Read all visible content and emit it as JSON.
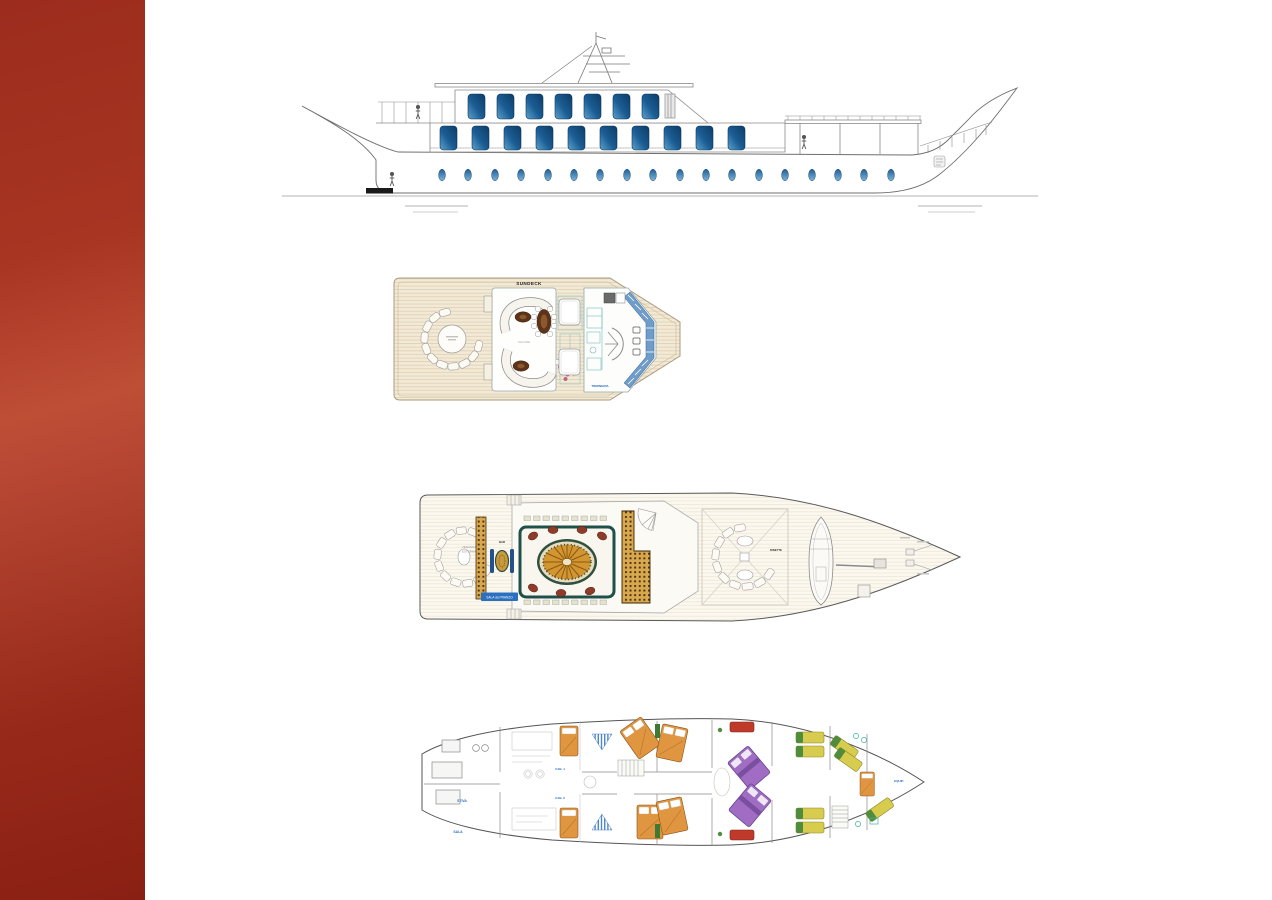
{
  "page": {
    "background": "#ffffff"
  },
  "sidebar": {
    "width_px": 145,
    "color_top": "#9c2c1d",
    "color_mid": "#bf4e37",
    "color_bottom": "#8a2013"
  },
  "profile_view": {
    "description": "Motor yacht side profile elevation drawing",
    "upper_deck_window_count": 7,
    "main_deck_window_count": 10,
    "hull_porthole_count": 18,
    "window_color": "#1b5d94",
    "porthole_color": "#2f74ad",
    "hull_color": "#ffffff",
    "line_color": "#6f6f6f"
  },
  "sun_deck": {
    "title": "SUNDECK",
    "label_salone": "SALONE",
    "label_timoneria": "TIMONERIA",
    "deck_color": "#f2e9d6",
    "windshield_color": "#6f9cc9",
    "table_color": "#5f3318",
    "pink_chair_color": "#c9628a"
  },
  "main_deck": {
    "label_veranda_line1": "VERANDA",
    "label_veranda_line2": "ESTERNA",
    "label_sala_pranzo": "SALA da PRANZO",
    "label_bar": "BAR",
    "label_dinette": "DINETTE",
    "carpet_border_color": "#20504a",
    "sunburst_color": "#d2952f",
    "armchair_color": "#8e3b2a",
    "armchair_count": 7,
    "bar_tile_color": "#d8a84e"
  },
  "lower_deck": {
    "label_stiva": "STIVA",
    "label_sala": "SALA",
    "label_cabina1": "CAB. 1",
    "label_cabina2": "CAB. 2",
    "label_equipaggio": "EQUIP.",
    "bed_orange": "#e09540",
    "bed_purple": "#a06cc4",
    "bed_yellow": "#d8cc4e",
    "pillow_green": "#4f8c3c",
    "sofa_red": "#c03a2b"
  }
}
